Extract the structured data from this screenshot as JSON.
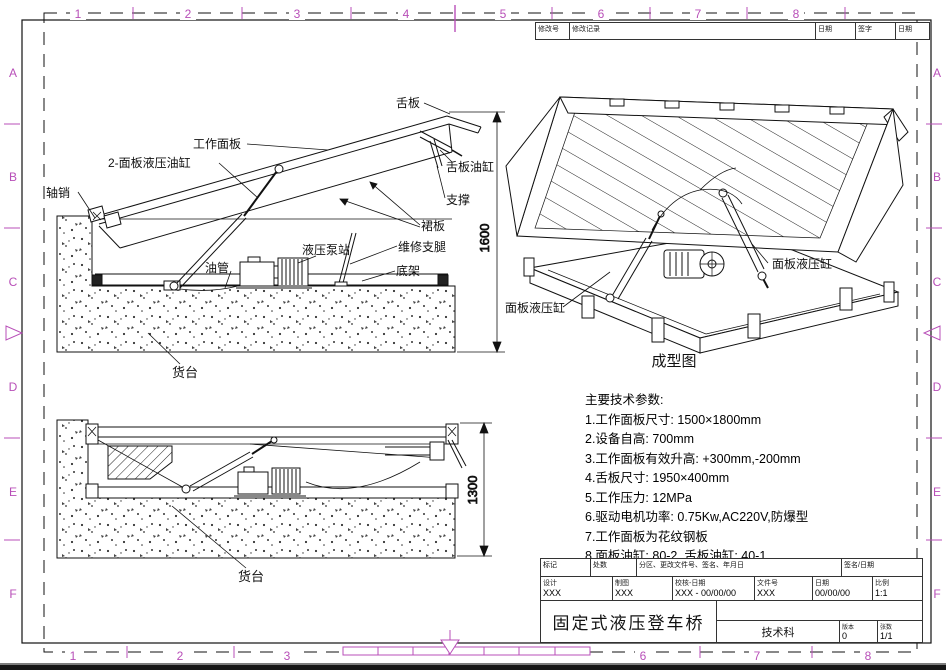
{
  "sheet": {
    "zone_numbers": [
      "1",
      "2",
      "3",
      "4",
      "5",
      "6",
      "7",
      "8"
    ],
    "zone_letters": [
      "A",
      "B",
      "C",
      "D",
      "E",
      "F"
    ],
    "colors": {
      "accent": "#b84fb8",
      "line": "#1a1a1a"
    }
  },
  "revision_table": {
    "headers": [
      "修改号",
      "修改记录",
      "日期",
      "签字",
      "日期"
    ]
  },
  "raised_view": {
    "labels": {
      "axle_pin": "轴销",
      "panel_cylinder": "2-面板液压油缸",
      "work_panel": "工作面板",
      "tongue": "舌板",
      "tongue_cylinder": "舌板油缸",
      "support": "支撑",
      "skirt": "裙板",
      "service_leg": "维修支腿",
      "pump_station": "液压泵站",
      "oil_pipe": "油管",
      "base_frame": "底架",
      "platform": "货台"
    },
    "dim_height": "1600"
  },
  "lowered_view": {
    "labels": {
      "platform": "货台"
    },
    "dim_height": "1300"
  },
  "iso_view": {
    "caption": "成型图",
    "labels": {
      "panel_cylinder_left": "面板液压缸",
      "panel_cylinder_right": "面板液压缸"
    }
  },
  "tech_specs": {
    "title": "主要技术参数:",
    "items": [
      "1.工作面板尺寸: 1500×1800mm",
      "2.设备自高: 700mm",
      "3.工作面板有效升高: +300mm,-200mm",
      "4.舌板尺寸: 1950×400mm",
      "5.工作压力: 12MPa",
      "6.驱动电机功率: 0.75Kw,AC220V,防爆型",
      "7.工作面板为花纹钢板",
      "8.面板油缸: 80-2, 舌板油缸: 40-1"
    ]
  },
  "title_block": {
    "mark_label": "标记",
    "count_label": "处数",
    "zone_label": "分区、更改文件号、签名、年月日",
    "sign_label": "签名/日期",
    "design_label": "设计",
    "design_value": "XXX",
    "draft_label": "制图",
    "draft_value": "XXX",
    "check_label": "校核-日期",
    "check_value": "XXX - 00/00/00",
    "file_label": "文件号",
    "file_value": "XXX",
    "date_label": "日期",
    "date_value": "00/00/00",
    "scale_label": "比例",
    "scale_value": "1:1",
    "drawing_title": "固定式液压登车桥",
    "department": "技术科",
    "version_label": "版本",
    "version_value": "0",
    "sheet_label": "张数",
    "sheet_value": "1/1"
  }
}
